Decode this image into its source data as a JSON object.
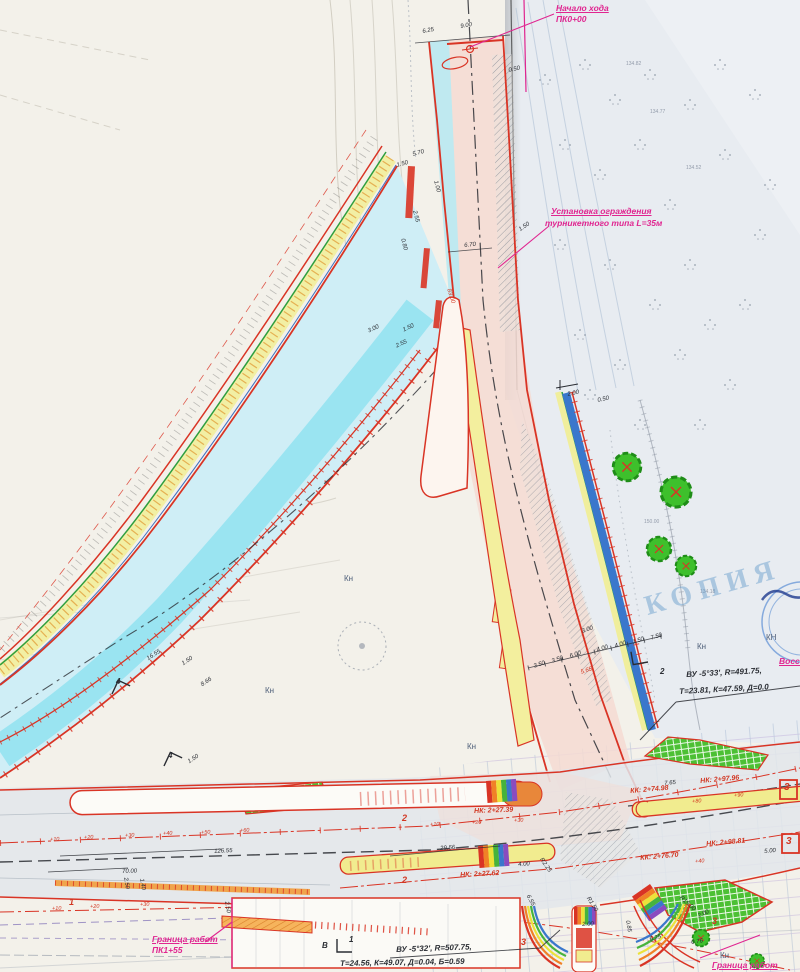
{
  "watermark": "КОПИЯ",
  "colors": {
    "accent_red": "#d23722",
    "magenta": "#e02590",
    "road_cyan": "#8ce1f0",
    "island_yellow": "#f1ec95",
    "ditch_blue": "#3a77cc",
    "grass_green": "#4cc034",
    "paper_left": "#f3f1ea",
    "paper_right": "#e8ecf1"
  },
  "labels": [
    {
      "t": "Начало хода",
      "x": 556,
      "y": 4,
      "s": 8.5,
      "c": "mag",
      "b": 1,
      "u": 1
    },
    {
      "t": "ПК0+00",
      "x": 556,
      "y": 15,
      "s": 8.5,
      "c": "mag",
      "b": 1
    },
    {
      "t": "Установка ограждения",
      "x": 551,
      "y": 207,
      "s": 8.5,
      "c": "mag",
      "b": 1,
      "u": 1
    },
    {
      "t": "турникетного типа L=35м",
      "x": 545,
      "y": 219,
      "s": 8.5,
      "c": "mag",
      "b": 1
    },
    {
      "t": "Граница работ",
      "x": 152,
      "y": 935,
      "s": 8.5,
      "c": "mag",
      "b": 1,
      "u": 1
    },
    {
      "t": "ПК1+55",
      "x": 152,
      "y": 946,
      "s": 8.5,
      "c": "mag",
      "b": 1
    },
    {
      "t": "Граница работ",
      "x": 712,
      "y": 961,
      "s": 8.5,
      "c": "mag",
      "b": 1,
      "u": 1
    },
    {
      "t": "Восст",
      "x": 779,
      "y": 657,
      "s": 8.5,
      "c": "mag",
      "b": 1,
      "u": 1
    },
    {
      "t": "ВУ -5°33', R=491.75,",
      "x": 686,
      "y": 671,
      "r": -3,
      "s": 8,
      "b": 1
    },
    {
      "t": "Т=23.81, К=47.59, Д=0.0",
      "x": 679,
      "y": 688,
      "r": -3,
      "s": 8,
      "b": 1
    },
    {
      "t": "ВУ -5°32', R=507.75,",
      "x": 396,
      "y": 946,
      "r": -2,
      "s": 8,
      "b": 1
    },
    {
      "t": "Т=24.56, К=49.07, Д=0.04, Б=0.59",
      "x": 340,
      "y": 960,
      "r": -1,
      "s": 8,
      "b": 1
    },
    {
      "t": "НК: 2+27.39",
      "x": 474,
      "y": 808,
      "r": -2,
      "s": 7,
      "c": "red",
      "b": 1
    },
    {
      "t": "КК: 2+74.98",
      "x": 630,
      "y": 788,
      "r": -5,
      "s": 7,
      "c": "red",
      "b": 1
    },
    {
      "t": "НК: 2+97.96",
      "x": 700,
      "y": 778,
      "r": -5,
      "s": 7,
      "c": "red",
      "b": 1
    },
    {
      "t": "КК: 2+76.70",
      "x": 640,
      "y": 855,
      "r": -5,
      "s": 7,
      "c": "red",
      "b": 1
    },
    {
      "t": "НК: 2+98.81",
      "x": 706,
      "y": 841,
      "r": -5,
      "s": 7,
      "c": "red",
      "b": 1
    },
    {
      "t": "НК: 2+27.62",
      "x": 460,
      "y": 872,
      "r": -3,
      "s": 7,
      "c": "red",
      "b": 1
    },
    {
      "t": "1",
      "x": 69,
      "y": 898,
      "s": 9,
      "c": "red",
      "b": 1
    },
    {
      "t": "2",
      "x": 402,
      "y": 814,
      "s": 9,
      "c": "red",
      "b": 1
    },
    {
      "t": "2",
      "x": 402,
      "y": 876,
      "s": 9,
      "c": "red",
      "b": 1
    },
    {
      "t": "3",
      "x": 712,
      "y": 917,
      "s": 9,
      "c": "red",
      "b": 1
    },
    {
      "t": "3",
      "x": 521,
      "y": 938,
      "s": 9,
      "c": "red",
      "b": 1
    },
    {
      "t": "3",
      "x": 784,
      "y": 783,
      "s": 10,
      "c": "red",
      "b": 1
    },
    {
      "t": "3",
      "x": 786,
      "y": 837,
      "s": 10,
      "c": "red",
      "b": 1
    },
    {
      "t": "4",
      "x": 116,
      "y": 678,
      "s": 8,
      "b": 1
    },
    {
      "t": "4",
      "x": 168,
      "y": 752,
      "s": 8,
      "b": 1
    },
    {
      "t": "2",
      "x": 660,
      "y": 668,
      "s": 8,
      "b": 1
    },
    {
      "t": "1",
      "x": 349,
      "y": 936,
      "s": 8,
      "b": 1
    },
    {
      "t": "+10",
      "x": 50,
      "y": 838,
      "r": -2,
      "s": 5.5,
      "c": "red"
    },
    {
      "t": "+20",
      "x": 84,
      "y": 836,
      "r": -2,
      "s": 5.5,
      "c": "red"
    },
    {
      "t": "+30",
      "x": 125,
      "y": 834,
      "r": -2,
      "s": 5.5,
      "c": "red"
    },
    {
      "t": "+40",
      "x": 163,
      "y": 832,
      "r": -2,
      "s": 5.5,
      "c": "red"
    },
    {
      "t": "+50",
      "x": 201,
      "y": 831,
      "r": -2,
      "s": 5.5,
      "c": "red"
    },
    {
      "t": "+60",
      "x": 240,
      "y": 829,
      "r": -2,
      "s": 5.5,
      "c": "red"
    },
    {
      "t": "+10",
      "x": 430,
      "y": 823,
      "r": -2,
      "s": 5.5,
      "c": "red"
    },
    {
      "t": "+20",
      "x": 472,
      "y": 821,
      "r": -2,
      "s": 5.5,
      "c": "red"
    },
    {
      "t": "+30",
      "x": 514,
      "y": 819,
      "r": -2,
      "s": 5.5,
      "c": "red"
    },
    {
      "t": "+80",
      "x": 692,
      "y": 800,
      "r": -5,
      "s": 5.5,
      "c": "red"
    },
    {
      "t": "+90",
      "x": 734,
      "y": 794,
      "r": -5,
      "s": 5.5,
      "c": "red"
    },
    {
      "t": "+40",
      "x": 695,
      "y": 860,
      "r": -5,
      "s": 5.5,
      "c": "red"
    },
    {
      "t": "+10",
      "x": 52,
      "y": 907,
      "r": -1,
      "s": 5.5,
      "c": "red"
    },
    {
      "t": "+20",
      "x": 90,
      "y": 905,
      "r": -1,
      "s": 5.5,
      "c": "red"
    },
    {
      "t": "+30",
      "x": 140,
      "y": 903,
      "r": -1,
      "s": 5.5,
      "c": "red"
    },
    {
      "t": "6.25",
      "x": 422,
      "y": 29,
      "r": -10,
      "s": 6
    },
    {
      "t": "9.00",
      "x": 460,
      "y": 24,
      "r": -10,
      "s": 6
    },
    {
      "t": "0.50",
      "x": 508,
      "y": 68,
      "r": -12,
      "s": 6
    },
    {
      "t": "5.70",
      "x": 412,
      "y": 152,
      "r": -15,
      "s": 6
    },
    {
      "t": "1.50",
      "x": 396,
      "y": 163,
      "r": -15,
      "s": 6
    },
    {
      "t": "1.00",
      "x": 438,
      "y": 180,
      "r": 75,
      "s": 6
    },
    {
      "t": "2.55",
      "x": 417,
      "y": 210,
      "r": 75,
      "s": 6
    },
    {
      "t": "0.80",
      "x": 405,
      "y": 238,
      "r": 75,
      "s": 6
    },
    {
      "t": "6.70",
      "x": 464,
      "y": 243,
      "r": -6,
      "s": 6
    },
    {
      "t": "1.50",
      "x": 518,
      "y": 228,
      "r": -35,
      "s": 6
    },
    {
      "t": "3.00",
      "x": 367,
      "y": 329,
      "r": -25,
      "s": 6
    },
    {
      "t": "1.50",
      "x": 402,
      "y": 328,
      "r": -25,
      "s": 6
    },
    {
      "t": "2.55",
      "x": 395,
      "y": 344,
      "r": -25,
      "s": 6
    },
    {
      "t": "83.00",
      "x": 451,
      "y": 288,
      "r": 72,
      "s": 6,
      "c": "red"
    },
    {
      "t": "2.00",
      "x": 567,
      "y": 392,
      "r": -12,
      "s": 6
    },
    {
      "t": "0.50",
      "x": 597,
      "y": 398,
      "r": -12,
      "s": 6
    },
    {
      "t": "16.55",
      "x": 146,
      "y": 657,
      "r": -33,
      "s": 6
    },
    {
      "t": "1.50",
      "x": 181,
      "y": 662,
      "r": -33,
      "s": 6
    },
    {
      "t": "8.66",
      "x": 200,
      "y": 683,
      "r": -33,
      "s": 6
    },
    {
      "t": "1.50",
      "x": 187,
      "y": 760,
      "r": -33,
      "s": 6
    },
    {
      "t": "3.50",
      "x": 533,
      "y": 664,
      "r": -18,
      "s": 6
    },
    {
      "t": "3.50",
      "x": 551,
      "y": 659,
      "r": -18,
      "s": 6
    },
    {
      "t": "6.00",
      "x": 569,
      "y": 654,
      "r": -18,
      "s": 6
    },
    {
      "t": "4.00",
      "x": 596,
      "y": 648,
      "r": -18,
      "s": 6
    },
    {
      "t": "4.00",
      "x": 614,
      "y": 644,
      "r": -18,
      "s": 6
    },
    {
      "t": "1.50",
      "x": 632,
      "y": 640,
      "r": -18,
      "s": 6
    },
    {
      "t": "7.50",
      "x": 650,
      "y": 636,
      "r": -18,
      "s": 6
    },
    {
      "t": "3.00",
      "x": 581,
      "y": 629,
      "r": -18,
      "s": 6
    },
    {
      "t": "5.65",
      "x": 580,
      "y": 670,
      "r": -18,
      "s": 6,
      "c": "red"
    },
    {
      "t": "126.55",
      "x": 214,
      "y": 849,
      "r": -3,
      "s": 6
    },
    {
      "t": "70.00",
      "x": 122,
      "y": 869,
      "r": -2,
      "s": 6
    },
    {
      "t": "29.56",
      "x": 440,
      "y": 846,
      "r": -4,
      "s": 6
    },
    {
      "t": "4.00",
      "x": 518,
      "y": 862,
      "r": -3,
      "s": 6
    },
    {
      "t": "6.55",
      "x": 530,
      "y": 894,
      "r": 62,
      "s": 6
    },
    {
      "t": "R2.25",
      "x": 543,
      "y": 857,
      "r": 55,
      "s": 6
    },
    {
      "t": "7.65",
      "x": 664,
      "y": 781,
      "r": -5,
      "s": 6
    },
    {
      "t": "5.00",
      "x": 764,
      "y": 849,
      "r": -5,
      "s": 6
    },
    {
      "t": "2.00",
      "x": 697,
      "y": 914,
      "r": -25,
      "s": 6
    },
    {
      "t": "0.76",
      "x": 691,
      "y": 940,
      "r": -8,
      "s": 6
    },
    {
      "t": "6.25",
      "x": 649,
      "y": 937,
      "r": -15,
      "s": 6
    },
    {
      "t": "R15.00",
      "x": 682,
      "y": 895,
      "r": 42,
      "s": 6
    },
    {
      "t": "2.50",
      "x": 229,
      "y": 901,
      "r": 80,
      "s": 6
    },
    {
      "t": "2.50",
      "x": 128,
      "y": 877,
      "r": 80,
      "s": 6
    },
    {
      "t": "1.40",
      "x": 144,
      "y": 878,
      "r": 80,
      "s": 6
    },
    {
      "t": "2.00",
      "x": 582,
      "y": 922,
      "r": -3,
      "s": 6
    },
    {
      "t": "R1.50",
      "x": 590,
      "y": 896,
      "r": 58,
      "s": 6
    },
    {
      "t": "0.85",
      "x": 630,
      "y": 920,
      "r": 80,
      "s": 6
    },
    {
      "t": "Кн",
      "x": 344,
      "y": 575,
      "s": 8,
      "c": "blu"
    },
    {
      "t": "Кн",
      "x": 265,
      "y": 687,
      "s": 8,
      "c": "blu"
    },
    {
      "t": "Кн",
      "x": 467,
      "y": 743,
      "s": 8,
      "c": "blu"
    },
    {
      "t": "Кн",
      "x": 697,
      "y": 643,
      "s": 8,
      "c": "blu"
    },
    {
      "t": "КН",
      "x": 766,
      "y": 634,
      "s": 8,
      "c": "blu"
    },
    {
      "t": "Кн",
      "x": 720,
      "y": 952,
      "s": 8,
      "c": "blu"
    },
    {
      "t": "134.82",
      "x": 626,
      "y": 62,
      "s": 5,
      "c": "gry"
    },
    {
      "t": "134.77",
      "x": 650,
      "y": 110,
      "s": 5,
      "c": "gry"
    },
    {
      "t": "134.52",
      "x": 686,
      "y": 166,
      "s": 5,
      "c": "gry"
    },
    {
      "t": "150.00",
      "x": 644,
      "y": 520,
      "s": 5,
      "c": "gry"
    },
    {
      "t": "134.18",
      "x": 700,
      "y": 590,
      "s": 5,
      "c": "gry"
    },
    {
      "t": "В",
      "x": 322,
      "y": 942,
      "s": 8,
      "b": 1
    }
  ]
}
